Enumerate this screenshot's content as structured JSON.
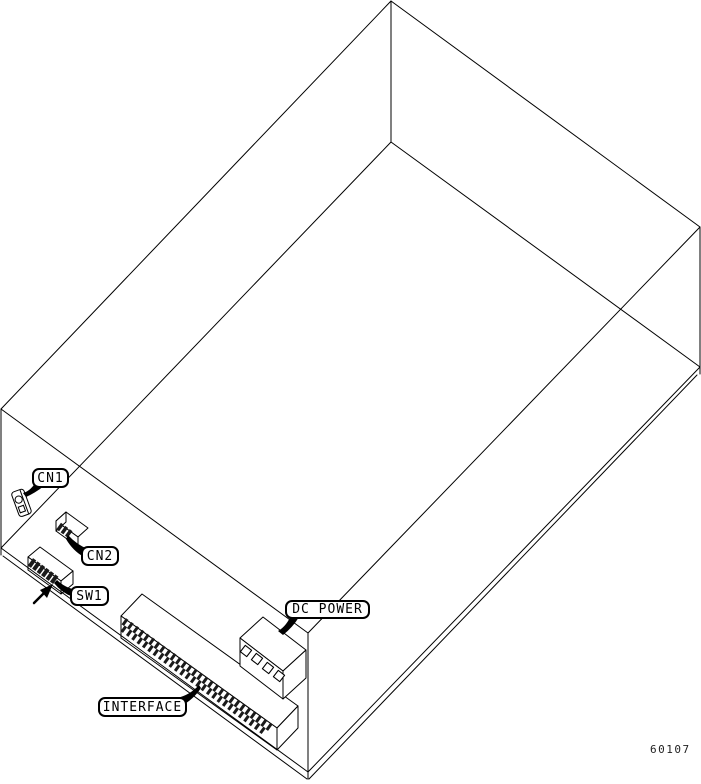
{
  "figure": {
    "part_number": "60107",
    "callouts": [
      {
        "id": "cn1",
        "label": "CN1"
      },
      {
        "id": "cn2",
        "label": "CN2"
      },
      {
        "id": "sw1",
        "label": "SW1"
      },
      {
        "id": "dc_power",
        "label": "DC POWER"
      },
      {
        "id": "interface",
        "label": "INTERFACE"
      }
    ],
    "colors": {
      "line": "#000000",
      "background": "#ffffff",
      "pin_fill": "#1a1a1a"
    }
  }
}
